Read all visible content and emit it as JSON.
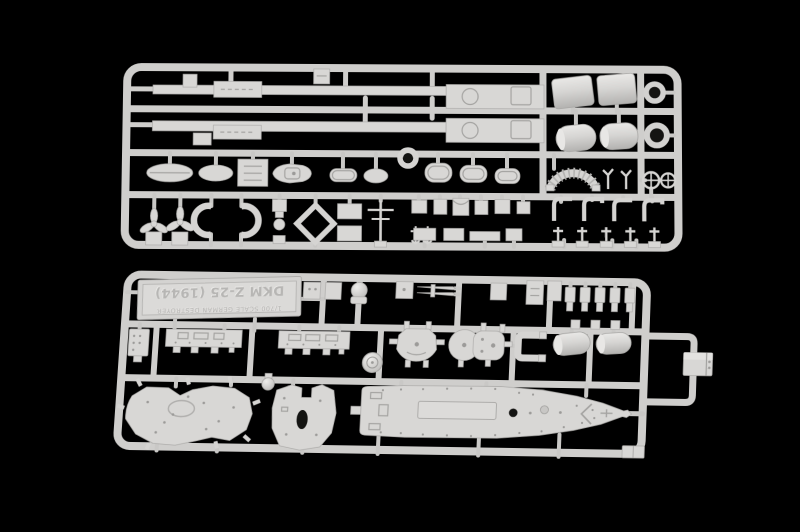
{
  "photo": {
    "background_color": "#000000",
    "plastic_color": "#d6d5d3",
    "plastic_highlight": "#ecebe9",
    "plastic_shadow": "#a9a8a6",
    "sprues_visible": 2
  },
  "nameplate": {
    "title": "DKM Z-25 (1944)",
    "subtitle": "1/700 SCALE GERMAN DESTROYER",
    "orientation": "upside-down"
  }
}
